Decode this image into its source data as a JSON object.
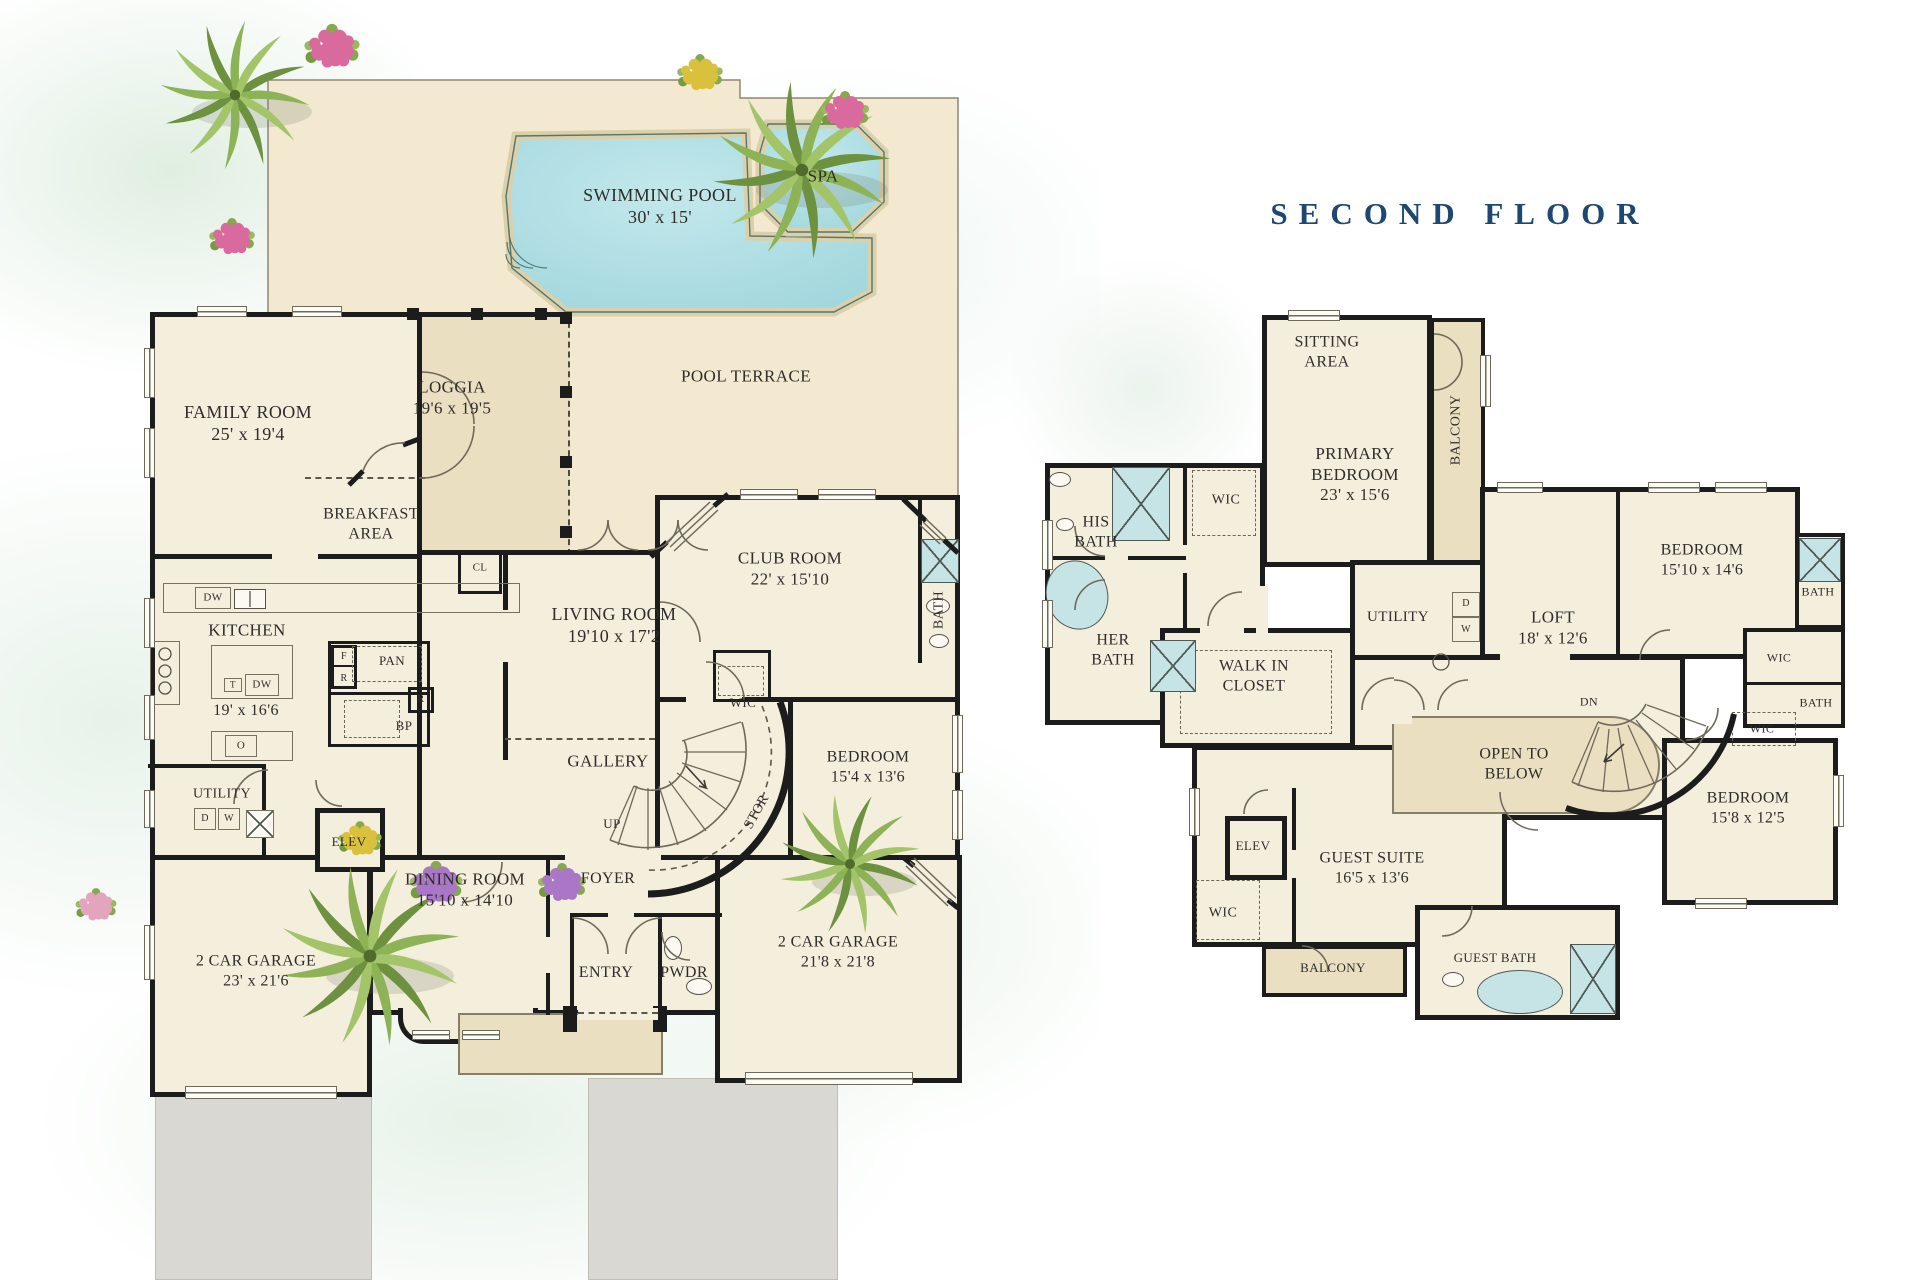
{
  "title": "SECOND FLOOR",
  "colors": {
    "wall": "#1c1c1c",
    "cream": "#f4eedd",
    "tan": "#ebdfc1",
    "terrace": "#f2e9d0",
    "pool_light": "#c3e8ec",
    "pool": "#9fd6dc",
    "coping": "#dcd0aa",
    "fixture": "#c6e3e6",
    "navy": "#1d4872",
    "ink": "#2e2d2a",
    "line": "#6f695b",
    "drive": "#d9d8d2"
  },
  "first_floor": {
    "labels": [
      {
        "n": "swimming-pool-label",
        "l": [
          "SWIMMING POOL",
          "30' x 15'"
        ],
        "x": 660,
        "y": 207,
        "s": 18
      },
      {
        "n": "spa-label",
        "l": [
          "SPA"
        ],
        "x": 823,
        "y": 177,
        "s": 17
      },
      {
        "n": "pool-terrace-label",
        "l": [
          "POOL TERRACE"
        ],
        "x": 746,
        "y": 377,
        "s": 17
      },
      {
        "n": "family-room-label",
        "l": [
          "FAMILY ROOM",
          "25' x 19'4"
        ],
        "x": 248,
        "y": 424,
        "s": 18
      },
      {
        "n": "loggia-label",
        "l": [
          "LOGGIA",
          "19'6 x 19'5"
        ],
        "x": 452,
        "y": 398,
        "s": 17
      },
      {
        "n": "breakfast-area-label",
        "l": [
          "BREAKFAST",
          "AREA"
        ],
        "x": 371,
        "y": 524,
        "s": 16
      },
      {
        "n": "kitchen-label",
        "l": [
          "KITCHEN"
        ],
        "x": 247,
        "y": 631,
        "s": 17
      },
      {
        "n": "kitchen-dims-label",
        "l": [
          "19' x 16'6"
        ],
        "x": 246,
        "y": 711,
        "s": 16
      },
      {
        "n": "cl-label",
        "l": [
          "CL"
        ],
        "x": 480,
        "y": 568,
        "s": 11
      },
      {
        "n": "living-room-label",
        "l": [
          "LIVING ROOM",
          "19'10 x 17'2"
        ],
        "x": 614,
        "y": 626,
        "s": 18
      },
      {
        "n": "club-room-label",
        "l": [
          "CLUB ROOM",
          "22' x 15'10"
        ],
        "x": 790,
        "y": 569,
        "s": 17
      },
      {
        "n": "bath-label",
        "l": [
          "BATH"
        ],
        "x": 939,
        "y": 610,
        "s": 14,
        "r": -90
      },
      {
        "n": "wic-label",
        "l": [
          "WIC"
        ],
        "x": 743,
        "y": 703,
        "s": 13
      },
      {
        "n": "bedroom-label",
        "l": [
          "BEDROOM",
          "15'4 x 13'6"
        ],
        "x": 868,
        "y": 767,
        "s": 16
      },
      {
        "n": "gallery-label",
        "l": [
          "GALLERY"
        ],
        "x": 608,
        "y": 762,
        "s": 17
      },
      {
        "n": "stor-label",
        "l": [
          "STOR"
        ],
        "x": 757,
        "y": 812,
        "s": 14,
        "r": -61
      },
      {
        "n": "up-label",
        "l": [
          "UP"
        ],
        "x": 612,
        "y": 824,
        "s": 13
      },
      {
        "n": "pan-label",
        "l": [
          "PAN"
        ],
        "x": 392,
        "y": 661,
        "s": 13
      },
      {
        "n": "fridge-f-label",
        "l": [
          "F"
        ],
        "x": 344,
        "y": 657,
        "s": 10
      },
      {
        "n": "fridge-r-label",
        "l": [
          "R"
        ],
        "x": 344,
        "y": 679,
        "s": 10
      },
      {
        "n": "r2-label",
        "l": [
          "R"
        ],
        "x": 421,
        "y": 700,
        "s": 10
      },
      {
        "n": "oven-label",
        "l": [
          "O"
        ],
        "x": 241,
        "y": 746,
        "s": 11
      },
      {
        "n": "dw1-label",
        "l": [
          "DW"
        ],
        "x": 213,
        "y": 598,
        "s": 11
      },
      {
        "n": "t-label",
        "l": [
          "T"
        ],
        "x": 233,
        "y": 685,
        "s": 9
      },
      {
        "n": "dw2-label",
        "l": [
          "DW"
        ],
        "x": 262,
        "y": 685,
        "s": 11
      },
      {
        "n": "utility-label",
        "l": [
          "UTILITY"
        ],
        "x": 222,
        "y": 794,
        "s": 14
      },
      {
        "n": "d-label",
        "l": [
          "D"
        ],
        "x": 205,
        "y": 819,
        "s": 10
      },
      {
        "n": "w-label",
        "l": [
          "W"
        ],
        "x": 229,
        "y": 819,
        "s": 10
      },
      {
        "n": "bp-label",
        "l": [
          "BP"
        ],
        "x": 404,
        "y": 726,
        "s": 13
      },
      {
        "n": "elev-label",
        "l": [
          "ELEV"
        ],
        "x": 349,
        "y": 842,
        "s": 13
      },
      {
        "n": "dining-room-label",
        "l": [
          "DINING ROOM",
          "15'10 x 14'10"
        ],
        "x": 465,
        "y": 890,
        "s": 17
      },
      {
        "n": "foyer-label",
        "l": [
          "FOYER"
        ],
        "x": 608,
        "y": 879,
        "s": 16
      },
      {
        "n": "entry-label",
        "l": [
          "ENTRY"
        ],
        "x": 606,
        "y": 973,
        "s": 16
      },
      {
        "n": "pwdr-label",
        "l": [
          "PWDR"
        ],
        "x": 684,
        "y": 973,
        "s": 16
      },
      {
        "n": "garage-left-label",
        "l": [
          "2 CAR GARAGE",
          "23' x 21'6"
        ],
        "x": 256,
        "y": 971,
        "s": 16
      },
      {
        "n": "garage-right-label",
        "l": [
          "2 CAR GARAGE",
          "21'8 x 21'8"
        ],
        "x": 838,
        "y": 952,
        "s": 16
      }
    ]
  },
  "second_floor": {
    "labels": [
      {
        "n": "sitting-area-label",
        "l": [
          "SITTING",
          "AREA"
        ],
        "x": 1327,
        "y": 352,
        "s": 16
      },
      {
        "n": "balcony-primary-label",
        "l": [
          "BALCONY"
        ],
        "x": 1456,
        "y": 430,
        "s": 14,
        "r": -90
      },
      {
        "n": "primary-bedroom-label",
        "l": [
          "PRIMARY",
          "BEDROOM",
          "23' x 15'6"
        ],
        "x": 1355,
        "y": 475,
        "s": 17
      },
      {
        "n": "his-bath-label",
        "l": [
          "HIS",
          "BATH"
        ],
        "x": 1096,
        "y": 532,
        "s": 16
      },
      {
        "n": "wic-a-label",
        "l": [
          "WIC"
        ],
        "x": 1226,
        "y": 500,
        "s": 14
      },
      {
        "n": "her-bath-label",
        "l": [
          "HER",
          "BATH"
        ],
        "x": 1113,
        "y": 650,
        "s": 16
      },
      {
        "n": "walk-in-closet-label",
        "l": [
          "WALK IN",
          "CLOSET"
        ],
        "x": 1254,
        "y": 676,
        "s": 16
      },
      {
        "n": "utility-2f-label",
        "l": [
          "UTILITY"
        ],
        "x": 1398,
        "y": 617,
        "s": 15
      },
      {
        "n": "d-2f-label",
        "l": [
          "D"
        ],
        "x": 1466,
        "y": 604,
        "s": 10
      },
      {
        "n": "w-2f-label",
        "l": [
          "W"
        ],
        "x": 1466,
        "y": 630,
        "s": 10
      },
      {
        "n": "loft-label",
        "l": [
          "LOFT",
          "18' x 12'6"
        ],
        "x": 1553,
        "y": 628,
        "s": 17
      },
      {
        "n": "bedroom-tr-label",
        "l": [
          "BEDROOM",
          "15'10 x 14'6"
        ],
        "x": 1702,
        "y": 560,
        "s": 16
      },
      {
        "n": "bath-a-label",
        "l": [
          "BATH"
        ],
        "x": 1818,
        "y": 592,
        "s": 12
      },
      {
        "n": "wic-b-label",
        "l": [
          "WIC"
        ],
        "x": 1779,
        "y": 658,
        "s": 12
      },
      {
        "n": "bath-b-label",
        "l": [
          "BATH"
        ],
        "x": 1816,
        "y": 703,
        "s": 12
      },
      {
        "n": "wic-c-label",
        "l": [
          "WIC"
        ],
        "x": 1762,
        "y": 729,
        "s": 12
      },
      {
        "n": "dn-label",
        "l": [
          "DN"
        ],
        "x": 1589,
        "y": 702,
        "s": 12
      },
      {
        "n": "open-below-label",
        "l": [
          "OPEN TO",
          "BELOW"
        ],
        "x": 1514,
        "y": 764,
        "s": 16
      },
      {
        "n": "bedroom-br-label",
        "l": [
          "BEDROOM",
          "15'8 x 12'5"
        ],
        "x": 1748,
        "y": 808,
        "s": 16
      },
      {
        "n": "elev-2f-label",
        "l": [
          "ELEV"
        ],
        "x": 1253,
        "y": 846,
        "s": 13
      },
      {
        "n": "guest-suite-label",
        "l": [
          "GUEST SUITE",
          "16'5 x 13'6"
        ],
        "x": 1372,
        "y": 868,
        "s": 16
      },
      {
        "n": "wic-d-label",
        "l": [
          "WIC"
        ],
        "x": 1223,
        "y": 913,
        "s": 14
      },
      {
        "n": "balcony-guest-label",
        "l": [
          "BALCONY"
        ],
        "x": 1333,
        "y": 968,
        "s": 13
      },
      {
        "n": "guest-bath-label",
        "l": [
          "GUEST BATH"
        ],
        "x": 1495,
        "y": 958,
        "s": 13
      }
    ]
  }
}
